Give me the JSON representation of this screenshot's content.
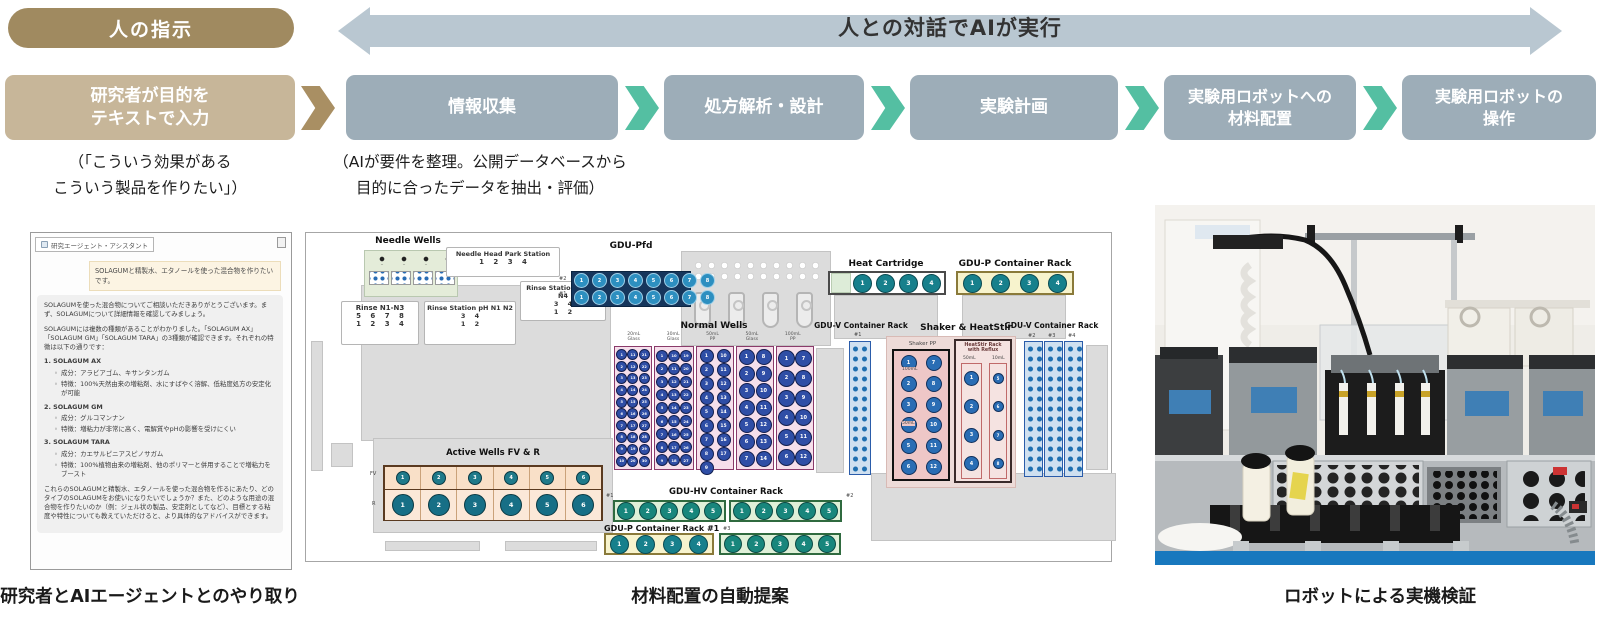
{
  "header": {
    "instruction_pill": "人の指示",
    "banner": "人との対話でAIが実行"
  },
  "flow": {
    "input_box": "研究者が目的を\nテキストで入力",
    "steps": [
      "情報収集",
      "処方解析・設計",
      "実験計画",
      "実験用ロボットへの\n材料配置",
      "実験用ロボットの\n操作"
    ]
  },
  "notes": {
    "left": "（「こういう効果がある\nこういう製品を作りたい」）",
    "right": "（AIが要件を整理。公開データベースから\n目的に合ったデータを抽出・評価）"
  },
  "chat": {
    "window_title": "研究エージェント・アシスタント",
    "user_message": "SOLAGUMと精製水、エタノールを使った混合物を作りたいです。",
    "ai_intro_1": "SOLAGUMを使った混合物についてご相談いただきありがとうございます。まず、SOLAGUMについて詳細情報を確認してみましょう。",
    "ai_intro_2": "SOLAGUMには複数の種類があることがわかりました。「SOLAGUM AX」「SOLAGUM GM」「SOLAGUM TARA」の3種類が確認できます。それぞれの特徴は以下の通りです：",
    "items": [
      {
        "name": "1. SOLAGUM AX",
        "component": "成分：アラビアゴム、キサンタンガム",
        "feature": "特徴：100%天然由来の増粘剤、水にすばやく溶解、低粘度処方の安定化が可能"
      },
      {
        "name": "2. SOLAGUM GM",
        "component": "成分：グルコマンナン",
        "feature": "特徴：増粘力が非常に高く、電解質やpHの影響を受けにくい"
      },
      {
        "name": "3. SOLAGUM TARA",
        "component": "成分：カエサルピニアスピノサガム",
        "feature": "特徴：100%植物由来の増粘剤、他のポリマーと併用することで増粘力をブースト"
      }
    ],
    "ai_outro": "これらのSOLAGUMと精製水、エタノールを使った混合物を作るにあたり、どのタイプのSOLAGUMをお使いになりたいでしょうか？また、どのような用途の混合物を作りたいのか（例：ジェル状の製品、安定剤としてなど）、目標とする粘度や特性についても教えていただけると、より具体的なアドバイスができます。"
  },
  "deck": {
    "labels": {
      "needle_wells": "Needle Wells",
      "needle_head": "Needle Head Park Station",
      "needle_head_nums": "1 2 3 4",
      "rinse1_title": "Rinse N1-N3",
      "rinse1_l1": "5 6 7 8",
      "rinse1_l2": "1 2 3 4",
      "rinse2_title": "Rinse Station pH N1 N2",
      "rinse2_l1": "3 4",
      "rinse2_l2": "1 2",
      "rinse3_title": "Rinse Station pH N3 N4",
      "rinse3_l1": "3 4",
      "rinse3_l2": "1 2",
      "gdu_pfd": "GDU-Pfd",
      "pfd_row2": "#2",
      "pfd_row1": "#1",
      "heat_cartridge": "Heat Cartridge",
      "gdu_p_top": "GDU-P Container Rack",
      "normal_wells": "Normal Wells",
      "nw_cols": [
        "20mL\nGlass",
        "30mL\nGlass",
        "50mL\nPP",
        "50mL\nGlass",
        "100mL\nPP"
      ],
      "gdu_v": "GDU-V Container Rack",
      "v1": "#1",
      "v2": "#2",
      "v3": "#3",
      "v4": "#4",
      "shaker_heatstir": "Shaker & HeatStir",
      "shaker_pp": "Shaker PP",
      "s100": "100mL",
      "s50": "50mL",
      "heatstir": "HeatStir Rack\nwith Reflux",
      "hs50": "50mL",
      "hs10": "10mL",
      "active_wells": "Active Wells FV & R",
      "fv": "FV",
      "r": "R",
      "gdu_hv": "GDU-HV Container Rack",
      "h1": "#1",
      "h2": "#2",
      "h3": "#3",
      "gdu_p1": "GDU-P Container Rack #1"
    },
    "wells": {
      "n4": [
        1,
        2,
        3,
        4
      ],
      "n5": [
        1,
        2,
        3,
        4,
        5
      ],
      "n6": [
        1,
        2,
        3,
        4,
        5,
        6
      ],
      "n8": [
        1,
        2,
        3,
        4,
        5,
        6,
        7,
        8
      ],
      "n12": [
        1,
        2,
        3,
        4,
        5,
        6,
        7,
        8,
        9,
        10,
        11,
        12
      ],
      "n14": [
        1,
        2,
        3,
        4,
        5,
        6,
        7,
        8,
        9,
        10,
        11,
        12,
        13,
        14
      ],
      "n17": [
        1,
        2,
        3,
        4,
        5,
        6,
        7,
        8,
        9,
        10,
        11,
        12,
        13,
        14,
        15,
        16,
        17
      ],
      "n27": [
        1,
        2,
        3,
        4,
        5,
        6,
        7,
        8,
        9,
        10,
        11,
        12,
        13,
        14,
        15,
        16,
        17,
        18,
        19,
        20,
        21,
        22,
        23,
        24,
        25,
        26,
        27
      ],
      "n30": [
        1,
        2,
        3,
        4,
        5,
        6,
        7,
        8,
        9,
        10,
        11,
        12,
        13,
        14,
        15,
        16,
        17,
        18,
        19,
        20,
        21,
        22,
        23,
        24,
        25,
        26,
        27,
        28,
        29,
        30
      ],
      "hs50": [
        1,
        2,
        3,
        4
      ],
      "hs10": [
        5,
        6,
        7,
        8
      ]
    }
  },
  "captions": {
    "left": "研究者とAIエージェントとのやり取り",
    "center": "材料配置の自動提案",
    "right": "ロボットによる実機検証"
  },
  "colors": {
    "pill": "#a08a60",
    "input_box": "#c7b699",
    "step_box": "#9dadb8",
    "banner": "#b9c7d1",
    "arrow_teal": "#54bfa2",
    "arrow_brown": "#a98f63",
    "table_edge_blue": "#1878be"
  }
}
